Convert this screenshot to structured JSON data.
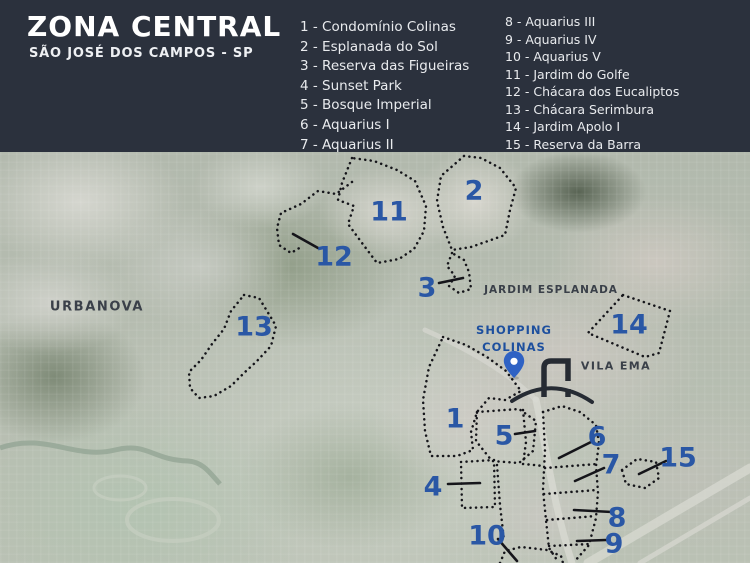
{
  "header": {
    "title": "ZONA CENTRAL",
    "subtitle": "SÃO JOSÉ DOS CAMPOS - SP"
  },
  "legend": {
    "items": [
      "1 - Condomínio Colinas",
      "2 - Esplanada do Sol",
      "3 - Reserva das Figueiras",
      "4 - Sunset Park",
      "5 - Bosque Imperial",
      "6 - Aquarius I",
      "7 - Aquarius II",
      "8 - Aquarius III",
      "9 - Aquarius IV",
      "10 - Aquarius V",
      "11 - Jardim do Golfe",
      "12 - Chácara dos Eucaliptos",
      "13 - Chácara Serimbura",
      "14 - Jardim Apolo I",
      "15 - Reserva da Barra"
    ]
  },
  "map": {
    "place_labels": {
      "urbanova": "URBANOVA",
      "jardim_esplanada": "JARDIM ESPLANADA",
      "vila_ema": "VILA EMA",
      "shopping_line1": "SHOPPING",
      "shopping_line2": "COLINAS"
    },
    "area_numbers": [
      "1",
      "2",
      "3",
      "4",
      "5",
      "6",
      "7",
      "8",
      "9",
      "10",
      "11",
      "12",
      "13",
      "14",
      "15"
    ],
    "icons": {
      "pin": "location-pin",
      "logo": "colinas-bridge-logo"
    }
  },
  "theme": {
    "colors": {
      "header_bg": "#2b313d",
      "number_blue": "#2a57a5",
      "shopping_blue": "#1d4f9e",
      "outline_black": "#15151a",
      "pin_blue": "#2f62c4",
      "logo_dark": "#262b33"
    }
  }
}
